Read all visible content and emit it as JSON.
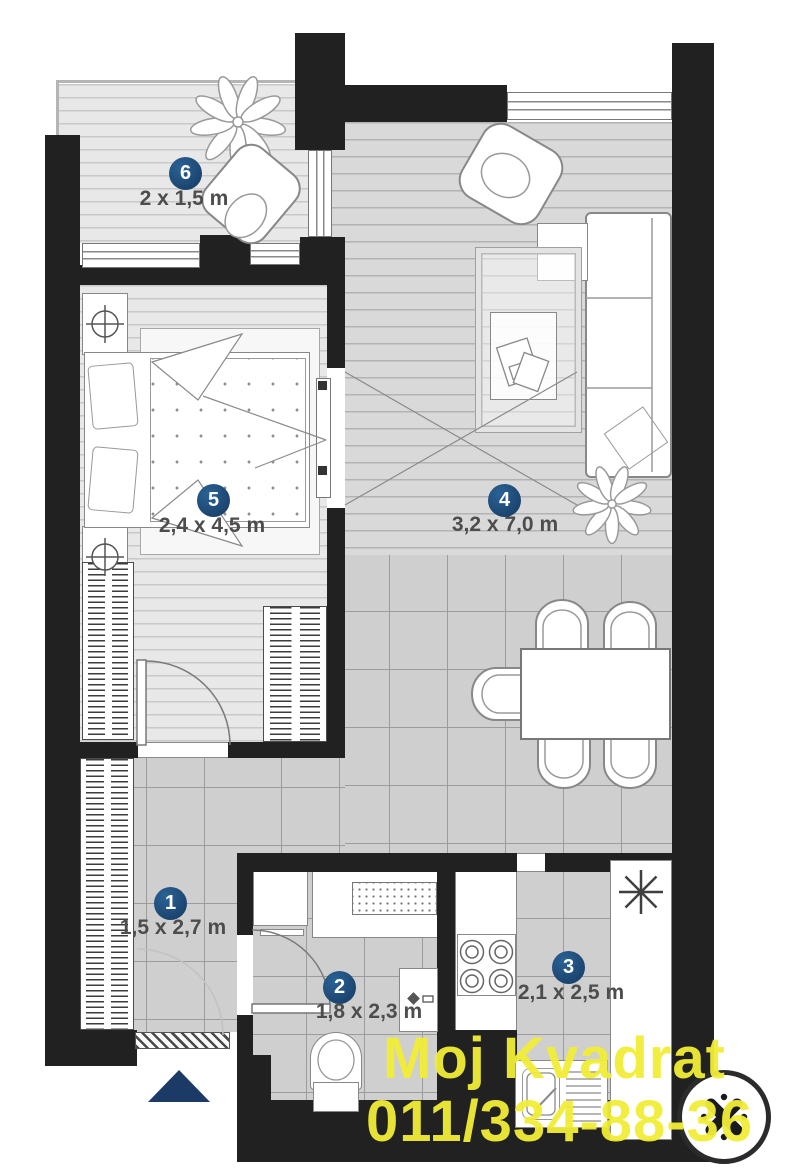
{
  "rooms": [
    {
      "number": "1",
      "dims": "1,5 x 2,7 m"
    },
    {
      "number": "2",
      "dims": "1,8 x 2,3 m"
    },
    {
      "number": "3",
      "dims": "2,1 x 2,5 m"
    },
    {
      "number": "4",
      "dims": "3,2 x 7,0 m"
    },
    {
      "number": "5",
      "dims": "2,4 x 4,5 m"
    },
    {
      "number": "6",
      "dims": "2 x 1,5 m"
    }
  ],
  "watermark": {
    "line1": "Moj Kvadrat",
    "line2": "011/334-88-36"
  },
  "colors": {
    "wall": "#212121",
    "badge_blue": "#1B4C7C",
    "entrance_arrow_blue": "#1C3A66",
    "watermark_yellow": "#F2EE37"
  }
}
